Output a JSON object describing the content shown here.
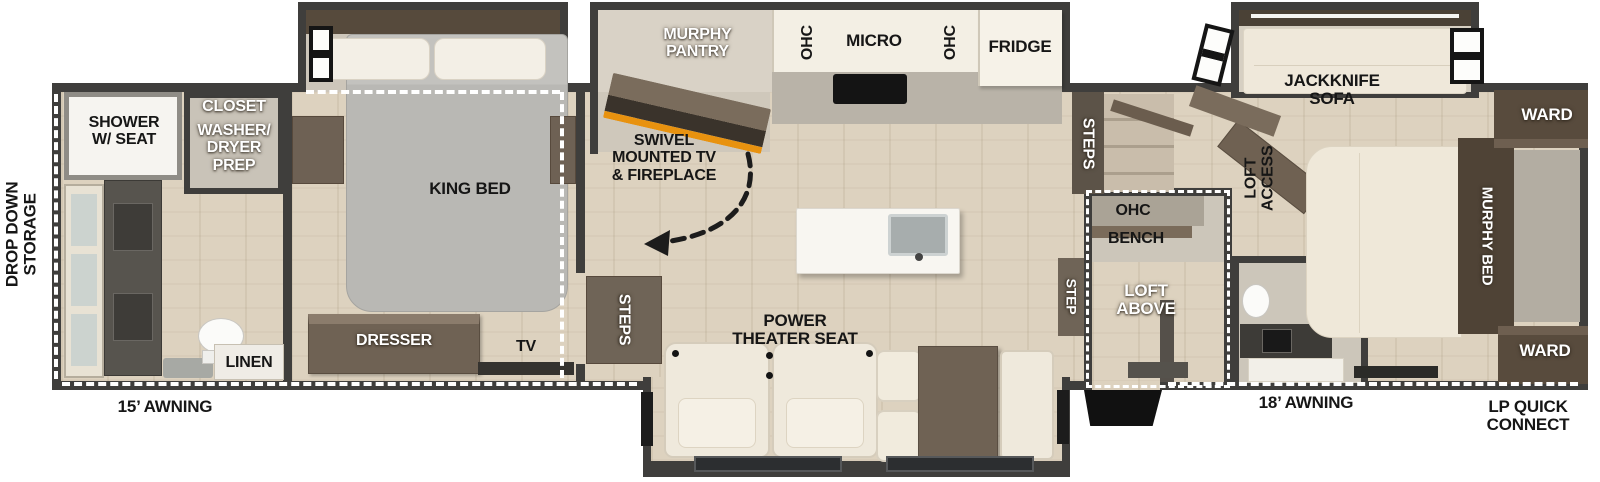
{
  "plan": {
    "exterior": {
      "drop_down_storage": "DROP DOWN\nSTORAGE",
      "awning_left": "15’ AWNING",
      "awning_right": "18’ AWNING",
      "lp_quick_connect": "LP QUICK\nCONNECT"
    },
    "rear_bath": {
      "shower": "SHOWER\nW/ SEAT",
      "closet": "CLOSET",
      "washer_dryer_prep": "WASHER/\nDRYER\nPREP",
      "linen": "LINEN"
    },
    "bedroom": {
      "king_bed": "KING BED",
      "dresser": "DRESSER",
      "tv": "TV",
      "steps": "STEPS"
    },
    "kitchen": {
      "murphy_pantry": "MURPHY\nPANTRY",
      "swivel_tv_fireplace": "SWIVEL\nMOUNTED TV\n& FIREPLACE",
      "ohc_left": "OHC",
      "micro": "MICRO",
      "ohc_right": "OHC",
      "fridge": "FRIDGE"
    },
    "living": {
      "power_theater_seat": "POWER\nTHEATER SEAT"
    },
    "mid": {
      "steps": "STEPS",
      "step": "STEP",
      "ohc": "OHC",
      "bench": "BENCH",
      "loft_above": "LOFT\nABOVE"
    },
    "front": {
      "loft_access": "LOFT\nACCESS",
      "jackknife_sofa": "JACKKNIFE\nSOFA",
      "ward_top": "WARD",
      "murphy_bed": "MURPHY BED",
      "ward_bottom": "WARD"
    },
    "colors": {
      "wall": "#3f3e3c",
      "floor_wood": "#ddd2bf",
      "dark_brown": "#584b3d",
      "cream": "#efe8da",
      "flame_accent": "#e8920f"
    }
  }
}
